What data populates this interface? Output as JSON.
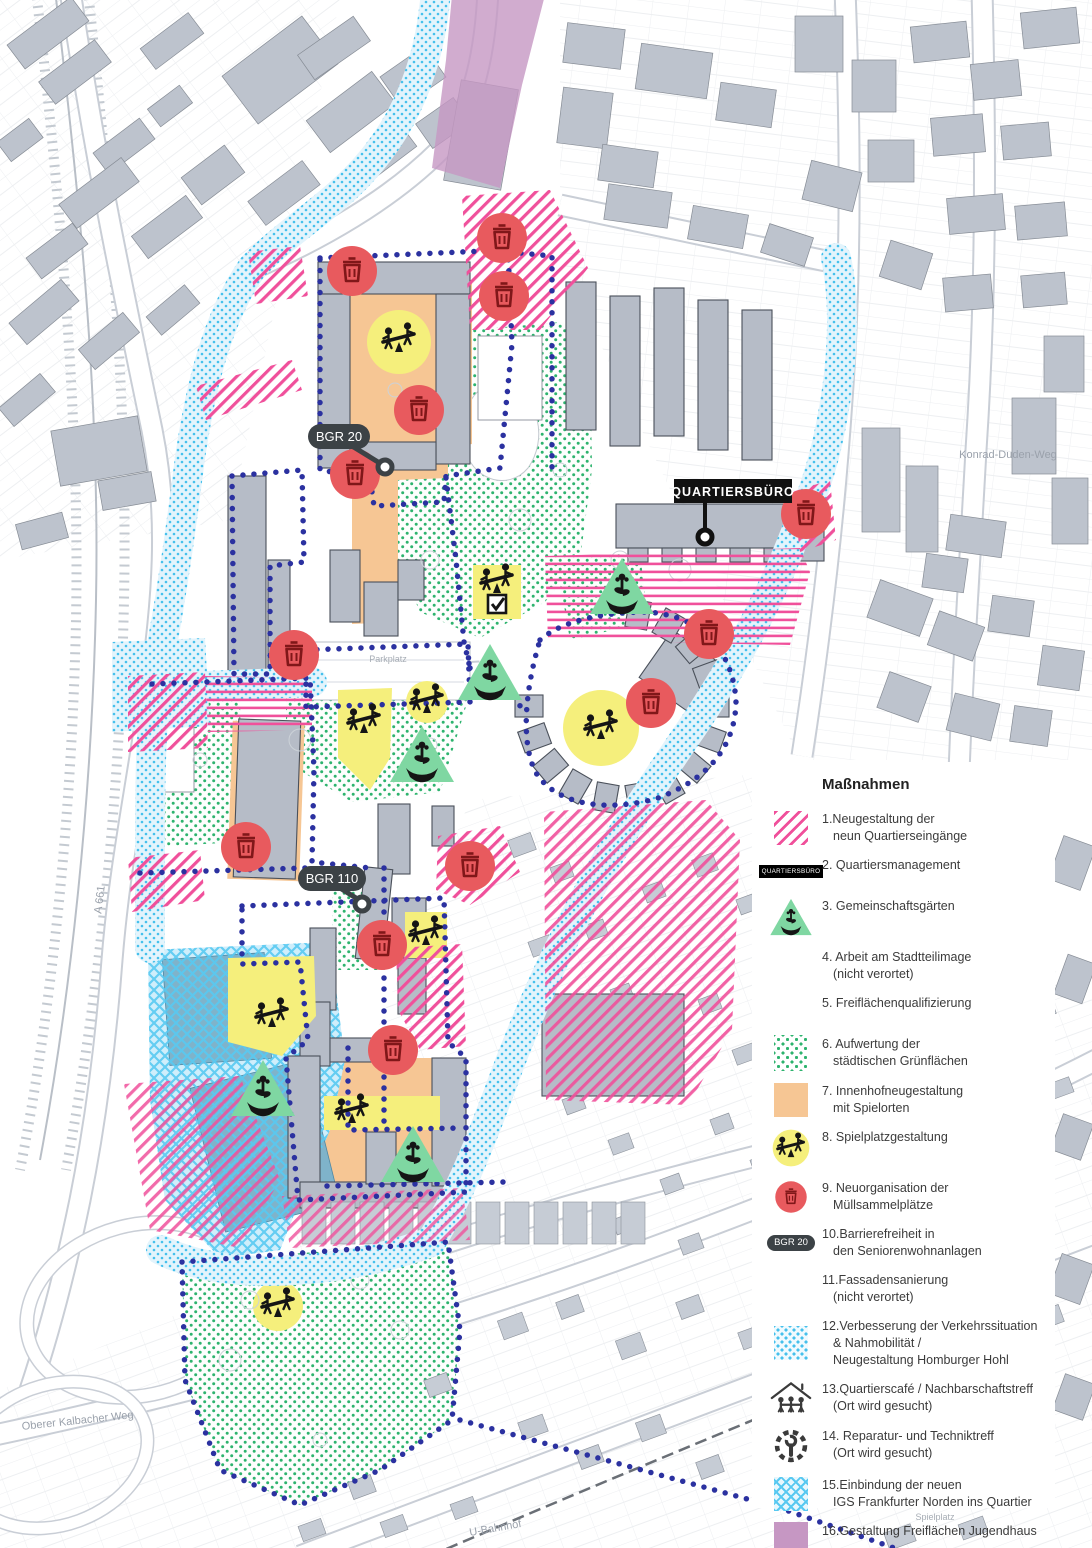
{
  "map": {
    "labels": {
      "quartiersbuero": "QUARTIERSBÜRO",
      "bgr20": "BGR 20",
      "bgr110": "BGR 110"
    },
    "street_labels": {
      "konrad_duden": "Konrad-Duden-Weg",
      "kalbacher": "Oberer Kalbacher Weg",
      "a661": "A 661",
      "ubahnhof": "U-Bahnhof",
      "parkplatz": "Parkplatz",
      "spielplatz": "Spielplatz"
    },
    "markers": {
      "trash": [
        [
          352,
          271
        ],
        [
          502,
          238
        ],
        [
          504,
          296
        ],
        [
          419,
          410
        ],
        [
          355,
          474
        ],
        [
          806,
          514
        ],
        [
          294,
          655
        ],
        [
          709,
          634
        ],
        [
          651,
          703
        ],
        [
          246,
          847
        ],
        [
          470,
          866
        ],
        [
          382,
          945
        ],
        [
          393,
          1050
        ]
      ],
      "community_garden": [
        [
          622,
          590
        ],
        [
          490,
          676
        ],
        [
          422,
          758
        ],
        [
          263,
          1092
        ],
        [
          413,
          1158
        ]
      ],
      "playground": [
        [
          399,
          341
        ],
        [
          497,
          582
        ],
        [
          427,
          702
        ],
        [
          364,
          722
        ],
        [
          601,
          728
        ],
        [
          426,
          934
        ],
        [
          272,
          1016
        ],
        [
          352,
          1112
        ],
        [
          278,
          1306
        ]
      ],
      "checkbox": [
        [
          497,
          604
        ]
      ]
    },
    "colors": {
      "pink": "#f0509b",
      "navy_dots": "#2b31a0",
      "green_dots": "#2db36e",
      "light_blue": "#45c0ec",
      "orange": "#f6c694",
      "yellow": "#f5ef7c",
      "triangle_green": "#7fd7a2",
      "red_marker": "#e85a5e",
      "purple": "#c697c3",
      "building_gray": "#b6bcc7"
    }
  },
  "legend": {
    "title": "Maßnahmen",
    "swatch_texts": {
      "quartiersbuero": "QUARTIERSBÜRO",
      "bgr": "BGR 20"
    },
    "items": [
      {
        "swatch": "pink-hatch",
        "lines": [
          "1.Neugestaltung der",
          "neun Quartierseingänge"
        ]
      },
      {
        "swatch": "quartiersbuero-label",
        "lines": [
          "2. Quartiersmanagement"
        ]
      },
      {
        "swatch": "garden-triangle",
        "lines": [
          "3. Gemeinschaftsgärten"
        ]
      },
      {
        "swatch": "none",
        "lines": [
          "4. Arbeit am Stadtteilimage",
          "(nicht verortet)"
        ]
      },
      {
        "swatch": "blue-dots-line",
        "lines": [
          "5. Freiflächenqualifizierung"
        ]
      },
      {
        "swatch": "green-dots",
        "lines": [
          "6. Aufwertung der",
          "städtischen Grünflächen"
        ]
      },
      {
        "swatch": "orange",
        "lines": [
          "7. Innenhofneugestaltung",
          "mit Spielorten"
        ]
      },
      {
        "swatch": "playground",
        "lines": [
          "8. Spielplatzgestaltung"
        ]
      },
      {
        "swatch": "trash",
        "lines": [
          "9. Neuorganisation der",
          "Müllsammelplätze"
        ]
      },
      {
        "swatch": "bgr-pill",
        "lines": [
          "10.Barrierefreiheit in",
          "den Seniorenwohnanlagen"
        ]
      },
      {
        "swatch": "none",
        "lines": [
          "11.Fassadensanierung",
          "(nicht verortet)"
        ]
      },
      {
        "swatch": "lightblue-dots",
        "lines": [
          "12.Verbesserung der Verkehrssituation",
          "& Nahmobilität /",
          "Neugestaltung Homburger Hohl"
        ]
      },
      {
        "swatch": "house-icon",
        "lines": [
          "13.Quartierscafé / Nachbarschaftstreff",
          "(Ort wird gesucht)"
        ]
      },
      {
        "swatch": "gear-icon",
        "lines": [
          "14. Reparatur- und Techniktreff",
          "(Ort wird gesucht)"
        ]
      },
      {
        "swatch": "blue-cross",
        "lines": [
          "15.Einbindung der neuen",
          "IGS Frankfurter Norden ins Quartier"
        ]
      },
      {
        "swatch": "purple",
        "lines": [
          "16.Gestaltung Freiflächen Jugendhaus"
        ]
      }
    ]
  }
}
